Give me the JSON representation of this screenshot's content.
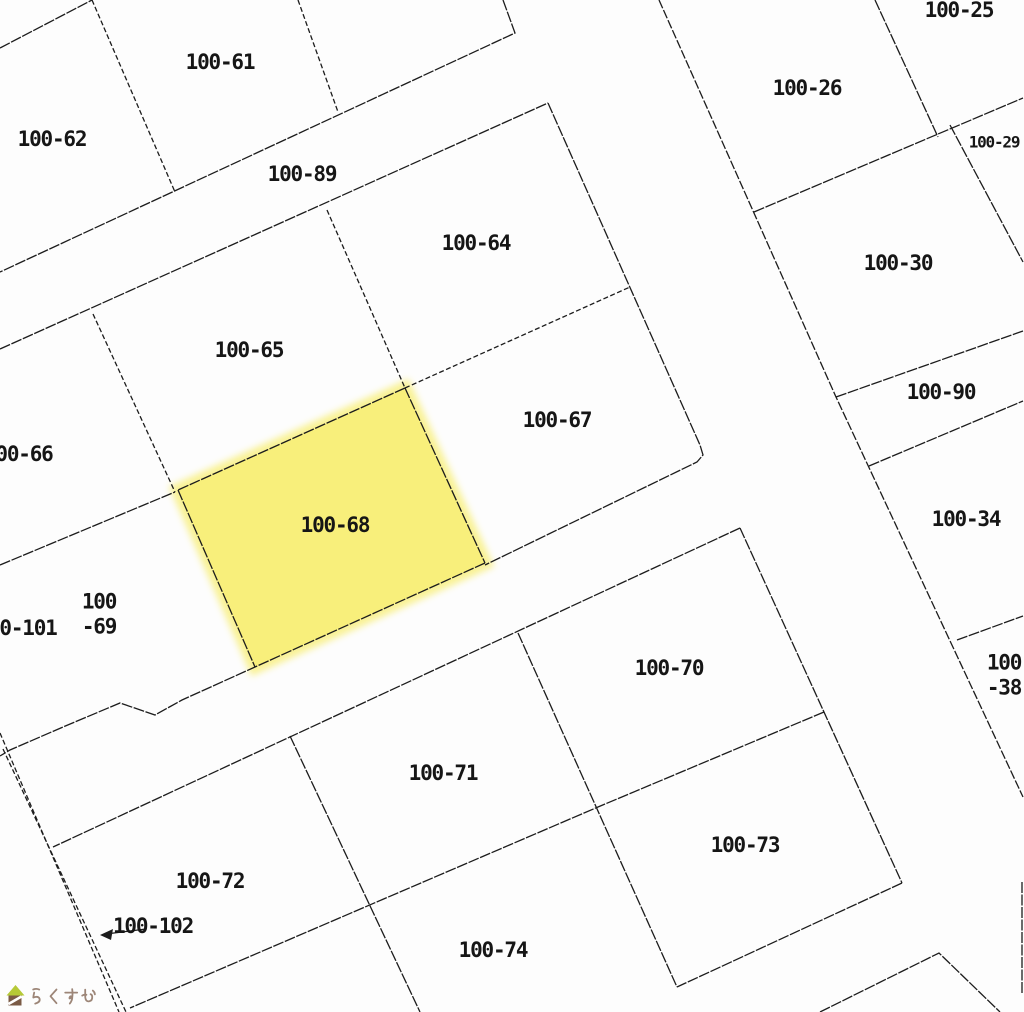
{
  "map": {
    "background": "#fdfdfd",
    "line_color": "#1c1c1c",
    "stroke_width": 1.3,
    "dash_default": "11 1.5",
    "label_font_size": 21,
    "highlight": {
      "parcel_id": "100-68",
      "fill": "#F8EF7B",
      "polygon": [
        [
          405,
          388
        ],
        [
          485,
          563
        ],
        [
          255,
          667
        ],
        [
          178,
          490
        ]
      ]
    },
    "segments": [
      {
        "name": "corner-top-left",
        "points": [
          [
            0,
            48
          ],
          [
            92,
            0
          ]
        ]
      },
      {
        "name": "boundary-61-62",
        "points": [
          [
            92,
            0
          ],
          [
            175,
            192
          ]
        ],
        "dash": "5 2.5"
      },
      {
        "name": "boundary-61-east",
        "points": [
          [
            298,
            0
          ],
          [
            338,
            112
          ]
        ],
        "dash": "5 2.5"
      },
      {
        "name": "road89-upper-edge",
        "points": [
          [
            503,
            0
          ],
          [
            515,
            33
          ],
          [
            0,
            272
          ]
        ]
      },
      {
        "name": "road89-lower-edge",
        "points": [
          [
            0,
            349
          ],
          [
            548,
            103
          ]
        ]
      },
      {
        "name": "block-mid-right-edge",
        "points": [
          [
            548,
            103
          ],
          [
            700,
            445
          ],
          [
            703,
            455
          ],
          [
            697,
            462
          ],
          [
            485,
            565
          ]
        ]
      },
      {
        "name": "road-south-upper-edge",
        "points": [
          [
            485,
            563
          ],
          [
            255,
            667
          ],
          [
            182,
            700
          ],
          [
            155,
            715
          ],
          [
            120,
            703
          ],
          [
            63,
            727
          ],
          [
            10,
            750
          ],
          [
            0,
            756
          ]
        ]
      },
      {
        "name": "boundary-67-68",
        "points": [
          [
            405,
            388
          ],
          [
            485,
            563
          ]
        ]
      },
      {
        "name": "boundary-65-68",
        "points": [
          [
            405,
            388
          ],
          [
            178,
            490
          ]
        ]
      },
      {
        "name": "boundary-68-west",
        "points": [
          [
            178,
            490
          ],
          [
            255,
            667
          ]
        ]
      },
      {
        "name": "boundary-64-65",
        "points": [
          [
            327,
            210
          ],
          [
            405,
            388
          ]
        ],
        "dash": "5 2.5"
      },
      {
        "name": "boundary-64-67",
        "points": [
          [
            405,
            388
          ],
          [
            630,
            287
          ]
        ],
        "dash": "5 2.5"
      },
      {
        "name": "boundary-65-66",
        "points": [
          [
            93,
            314
          ],
          [
            175,
            492
          ]
        ],
        "dash": "5 2.5"
      },
      {
        "name": "boundary-66-69",
        "points": [
          [
            0,
            565
          ],
          [
            175,
            492
          ]
        ]
      },
      {
        "name": "road-south-lower-edge",
        "points": [
          [
            740,
            528
          ],
          [
            53,
            847
          ]
        ]
      },
      {
        "name": "block-south-right-edge",
        "points": [
          [
            740,
            528
          ],
          [
            902,
            883
          ]
        ]
      },
      {
        "name": "boundary-73-south",
        "points": [
          [
            902,
            883
          ],
          [
            677,
            987
          ]
        ]
      },
      {
        "name": "boundary-70-71",
        "points": [
          [
            518,
            633
          ],
          [
            677,
            987
          ]
        ]
      },
      {
        "name": "boundary-70-73-74",
        "points": [
          [
            824,
            712
          ],
          [
            598,
            807
          ],
          [
            365,
            907
          ],
          [
            130,
            1008
          ]
        ]
      },
      {
        "name": "boundary-71-72",
        "points": [
          [
            290,
            736
          ],
          [
            420,
            1012
          ]
        ]
      },
      {
        "name": "strip-102-west-line",
        "points": [
          [
            0,
            733
          ],
          [
            119,
            1012
          ]
        ],
        "dash": "5 2.5"
      },
      {
        "name": "strip-102-east-line",
        "points": [
          [
            3,
            749
          ],
          [
            126,
            1012
          ]
        ],
        "dash": "5 2.5"
      },
      {
        "name": "road-east-right-edge",
        "points": [
          [
            659,
            0
          ],
          [
            836,
            397
          ],
          [
            1023,
            797
          ]
        ],
        "dash": "9 2"
      },
      {
        "name": "boundary-25-29",
        "points": [
          [
            754,
            212
          ],
          [
            1023,
            98
          ]
        ]
      },
      {
        "name": "boundary-25-26",
        "points": [
          [
            875,
            0
          ],
          [
            938,
            137
          ]
        ]
      },
      {
        "name": "boundary-29-30",
        "points": [
          [
            950,
            125
          ],
          [
            1023,
            262
          ]
        ]
      },
      {
        "name": "strip-90-upper-edge",
        "points": [
          [
            836,
            397
          ],
          [
            1023,
            331
          ]
        ]
      },
      {
        "name": "strip-90-lower-edge",
        "points": [
          [
            869,
            466
          ],
          [
            1023,
            401
          ]
        ]
      },
      {
        "name": "boundary-34-38",
        "points": [
          [
            957,
            640
          ],
          [
            1023,
            616
          ]
        ]
      },
      {
        "name": "parcel-corner-bottom-right",
        "points": [
          [
            820,
            1012
          ],
          [
            939,
            953
          ],
          [
            1000,
            1012
          ]
        ]
      },
      {
        "name": "edge-right-sliver",
        "points": [
          [
            1022,
            882
          ],
          [
            1022,
            993
          ]
        ]
      }
    ],
    "labels": [
      {
        "id": "100-25",
        "text": "100-25",
        "x": 959,
        "y": 10
      },
      {
        "id": "100-26",
        "text": "100-26",
        "x": 807,
        "y": 88
      },
      {
        "id": "100-29",
        "text": "100-29",
        "x": 994,
        "y": 142,
        "size": 16
      },
      {
        "id": "100-30",
        "text": "100-30",
        "x": 898,
        "y": 263
      },
      {
        "id": "100-61",
        "text": "100-61",
        "x": 220,
        "y": 62
      },
      {
        "id": "100-62",
        "text": "100-62",
        "x": 52,
        "y": 139
      },
      {
        "id": "100-89",
        "text": "100-89",
        "x": 302,
        "y": 174
      },
      {
        "id": "100-64",
        "text": "100-64",
        "x": 476,
        "y": 243
      },
      {
        "id": "100-65",
        "text": "100-65",
        "x": 249,
        "y": 350
      },
      {
        "id": "100-67",
        "text": "100-67",
        "x": 557,
        "y": 420
      },
      {
        "id": "100-68",
        "text": "100-68",
        "x": 335,
        "y": 525
      },
      {
        "id": "100-66",
        "text": "00-66",
        "x": 24,
        "y": 454
      },
      {
        "id": "100-101",
        "text": "0-101",
        "x": 28,
        "y": 628
      },
      {
        "id": "100-69",
        "lines": [
          "100",
          "-69"
        ],
        "x": 99,
        "y": 614
      },
      {
        "id": "100-90",
        "text": "100-90",
        "x": 941,
        "y": 392
      },
      {
        "id": "100-34",
        "text": "100-34",
        "x": 966,
        "y": 519
      },
      {
        "id": "100-38",
        "lines": [
          "100",
          "-38"
        ],
        "x": 1004,
        "y": 675
      },
      {
        "id": "100-70",
        "text": "100-70",
        "x": 669,
        "y": 668
      },
      {
        "id": "100-71",
        "text": "100-71",
        "x": 443,
        "y": 773
      },
      {
        "id": "100-72",
        "text": "100-72",
        "x": 210,
        "y": 881
      },
      {
        "id": "100-73",
        "text": "100-73",
        "x": 745,
        "y": 845
      },
      {
        "id": "100-74",
        "text": "100-74",
        "x": 493,
        "y": 950
      },
      {
        "id": "100-102",
        "text": "100-102",
        "x": 153,
        "y": 926
      }
    ],
    "arrow": {
      "label_id": "100-102",
      "from": [
        146,
        929
      ],
      "to": [
        100,
        935
      ]
    },
    "logo": {
      "text": "らくすむ",
      "text_color": "#9d8678",
      "roof_color": "#b6c937",
      "body_color": "#7a5a45",
      "x": 7,
      "y": 985
    }
  }
}
